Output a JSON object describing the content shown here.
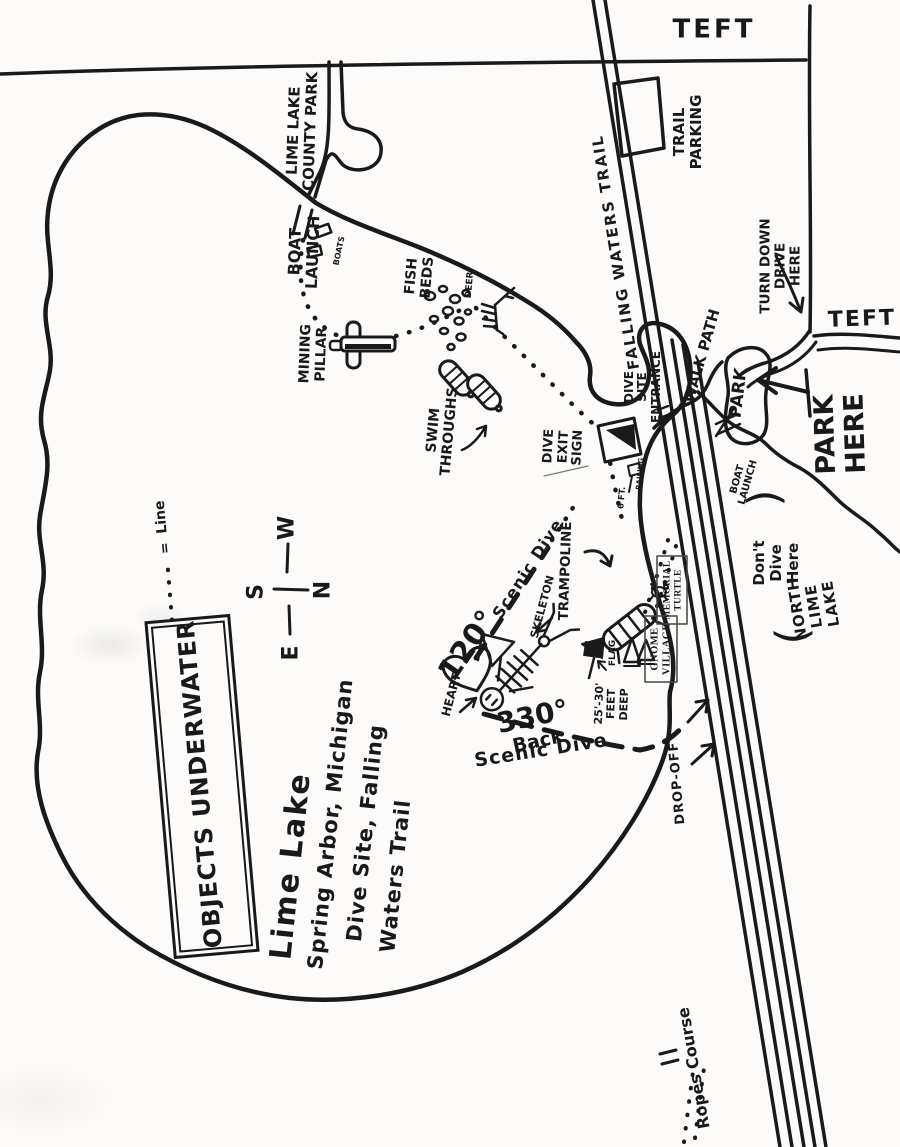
{
  "colors": {
    "ink": "#1a1a1a",
    "paper": "#fcfbf9"
  },
  "title_box": {
    "text": "OBJECTS UNDERWATER"
  },
  "title": [
    "Lime Lake",
    "Spring Arbor, Michigan",
    "Dive Site, Falling",
    "Waters Trail"
  ],
  "compass": {
    "n": "N",
    "s": "S",
    "e": "E",
    "w": "W"
  },
  "legend": {
    "line_eq": "=",
    "line_word": "Line",
    "ropes_eq": "=",
    "ropes_word": "Ropes Course"
  },
  "roads": {
    "teft_top": "TEFT",
    "teft_right": "TEFT"
  },
  "labels": {
    "trail_parking": "TRAIL\nPARKING",
    "falling_waters_trail": "FALLING WATERS TRAIL",
    "lime_lake_county_park": "LIME LAKE\nCOUNTY PARK",
    "boat_launch_north": "BOAT\nLAUNCH",
    "boats": "BOATS",
    "fish_beds": "FISH\nBEDS",
    "deer": "DEER",
    "mining_pillar": "MINING\nPILLAR",
    "swim_throughs": "SWIM\nTHROUGHS",
    "dive_exit_sign": "DIVE\nEXIT\nSIGN",
    "railing": "RAILING",
    "six_ft": "6 FT.",
    "dive_site_entrance": "DIVE\nSITE\nENTRANCE",
    "walk_path": "WALK PATH",
    "turn_down_drive_here": "TURN DOWN\nDRIVE\nHERE",
    "park_lot": "PARK",
    "park_here": "PARK\nHERE",
    "boat_launch_south": "BOAT\nLAUNCH",
    "north_lime_lake": "NORTH LIME LAKE",
    "dont_dive_here": "Don't\nDive\nHere",
    "paren_open": "(",
    "paren_close": ")",
    "drop_off": "DROP-OFF",
    "scenic_120_deg": "120°",
    "scenic_120_text": "Scenic Dive",
    "skeleton": "SKELETON",
    "trampoline": "TRAMPOLINE",
    "heart": "HEART",
    "flag": "FLAG",
    "gnome_village": "GNOME\nVILLAGE",
    "memorial_turtle": "MEMORIAL\nTURTLE",
    "back_330_deg": "330°",
    "back_330_word": "Back",
    "scenic_dive_back": "Scenic Dive",
    "feet_deep": "25'-30'\nFEET\nDEEP"
  }
}
